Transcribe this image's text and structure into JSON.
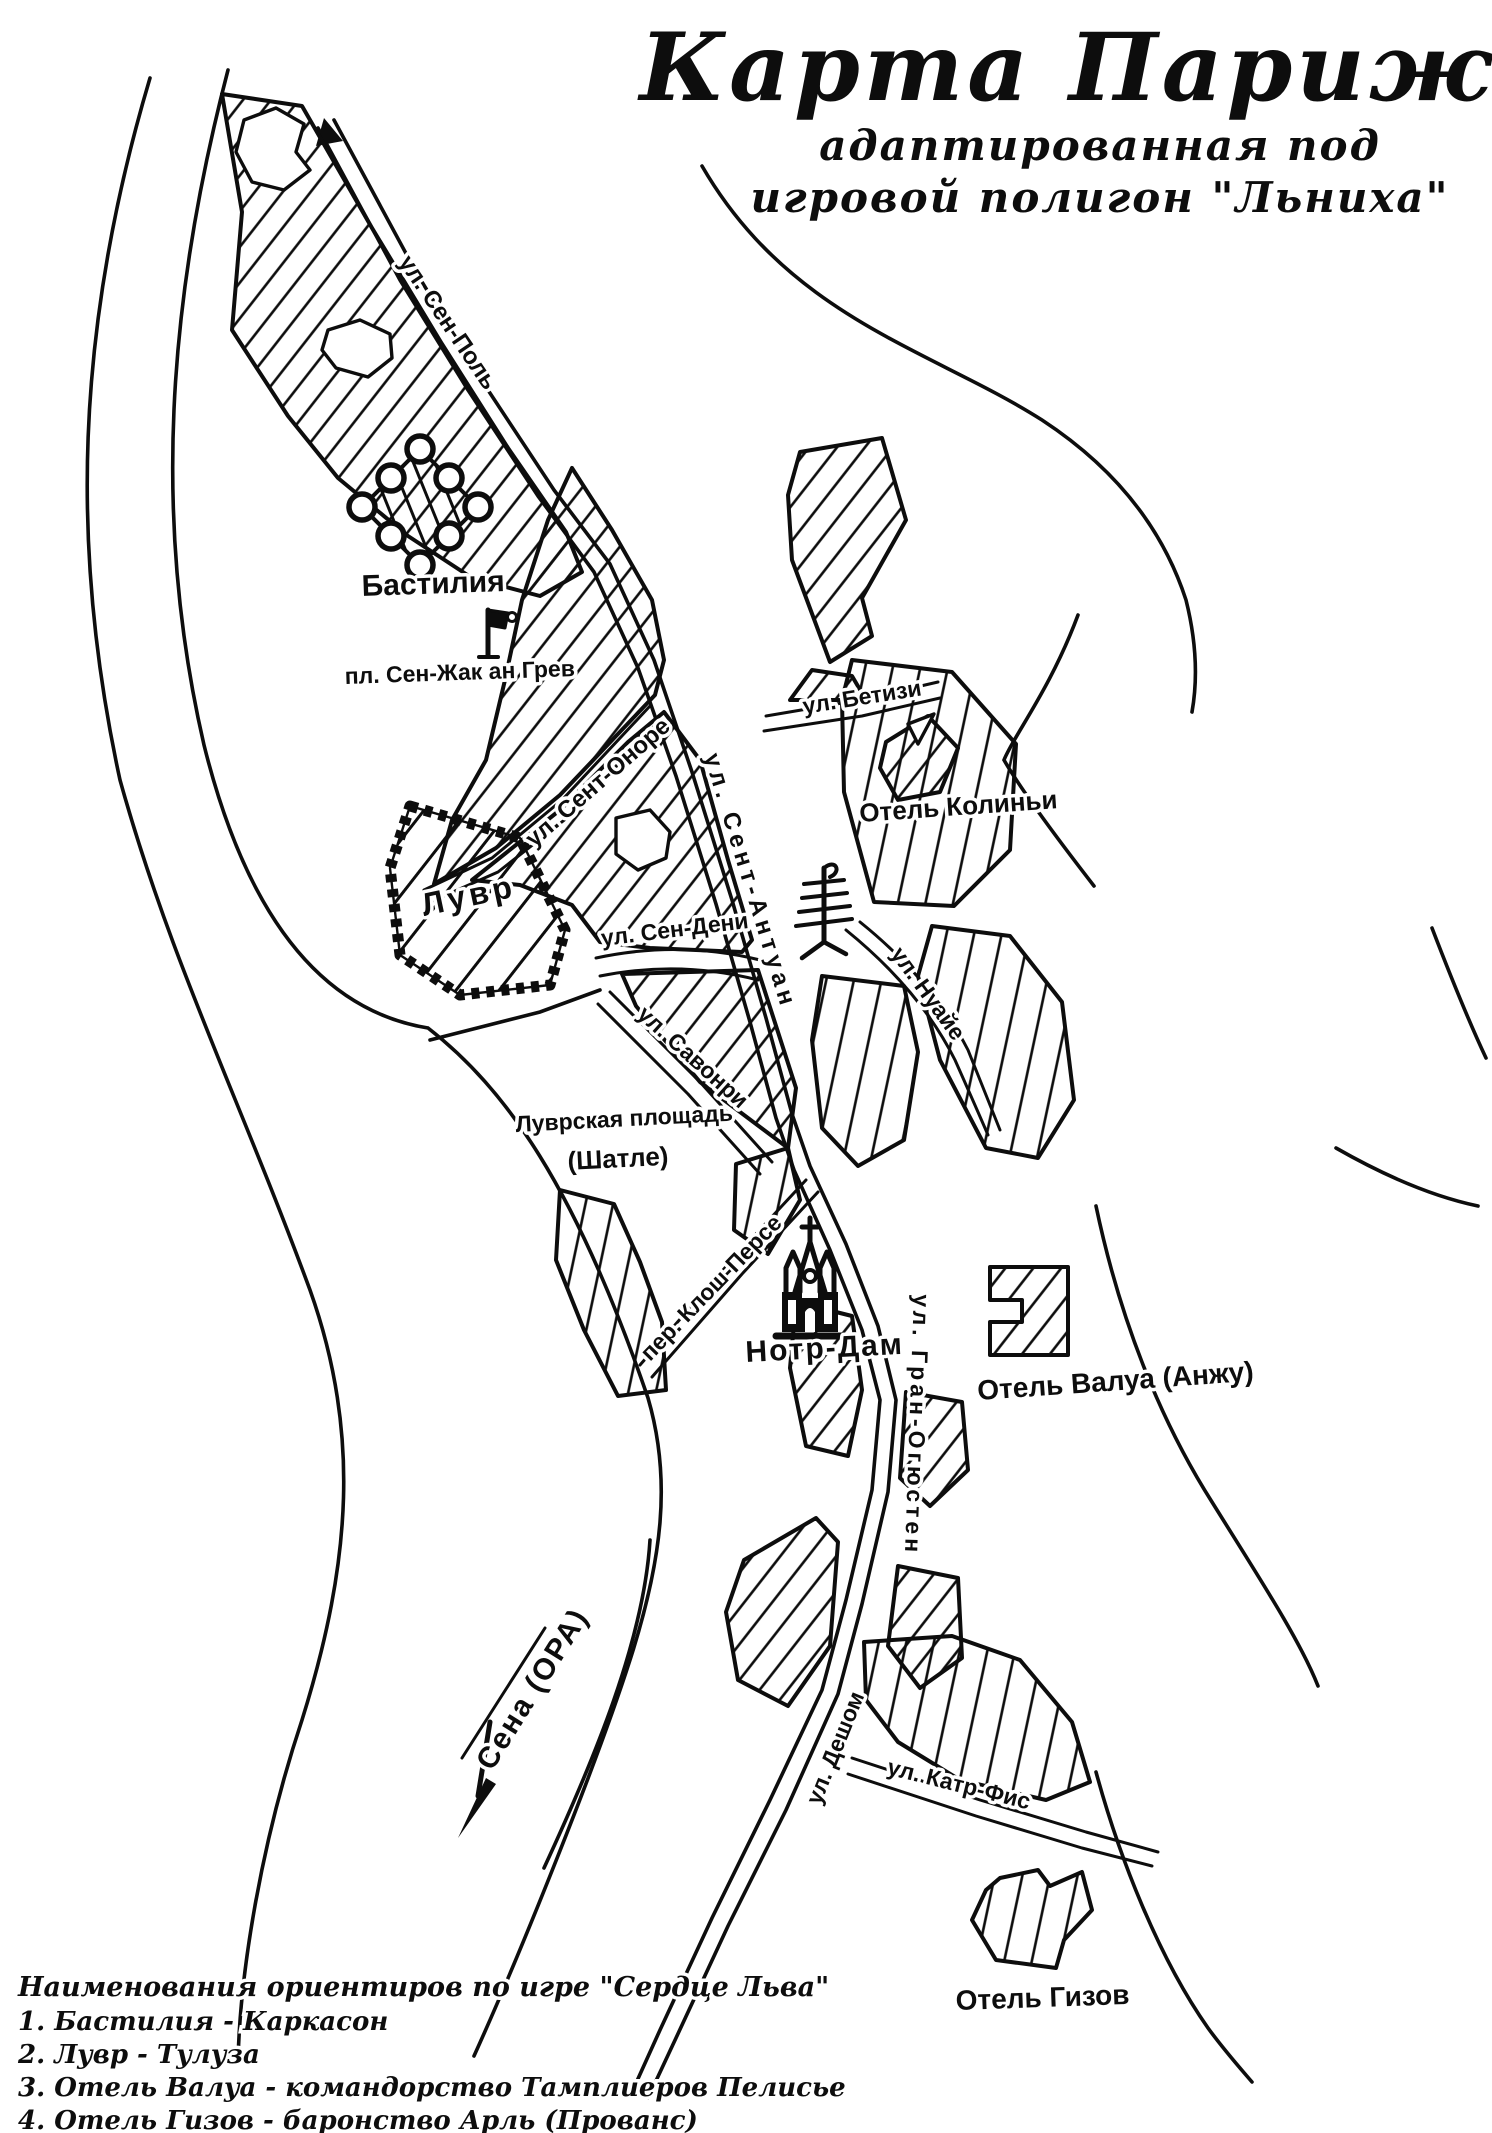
{
  "title": {
    "line1": "Карта Парижа",
    "line2": "адаптированная под",
    "line3": "игровой полигон \"Льниха\""
  },
  "legend": {
    "heading": "Наименования ориентиров по игре \"Сердце Льва\"",
    "items": [
      "1. Бастилия - Каркасон",
      "2. Лувр - Тулуза",
      "3. Отель Валуа - командорство Тамплиеров Пелисье",
      "4. Отель Гизов - баронство Арль (Прованс)"
    ]
  },
  "places": {
    "bastille": "Бастилия",
    "place_sen_zhak": "пл. Сен-Жак ан Грев",
    "louvre": "Лувр",
    "hotel_colini": "Отель Колиньи",
    "louvre_square": "Луврская площадь",
    "louvre_square_alt": "(Шатле)",
    "notre_dame": "Нотр-Дам",
    "hotel_valois": "Отель Валуа (Анжу)",
    "hotel_guise": "Отель Гизов",
    "seine": "Сена (ОРА)"
  },
  "streets": {
    "sen_pol": "ул. Сен-Поль",
    "sent_onore": "ул. Сент-Оноре",
    "sent_antuan": "ул. Сент-Антуан",
    "sen_deni": "ул. Сен-Дени",
    "betizi": "ул. Бетизи",
    "savonri": "ул. Савонри",
    "klosh_perse": "пер. Клош-Персе",
    "nuaye": "ул. Нуайе",
    "gran_ogyusten": "ул. Гран-Огюстен",
    "deshom": "ул. Дешом",
    "katr_fis": "ул. Катр-Фис"
  },
  "colors": {
    "ink": "#0d0d0d",
    "paper": "#ffffff"
  }
}
